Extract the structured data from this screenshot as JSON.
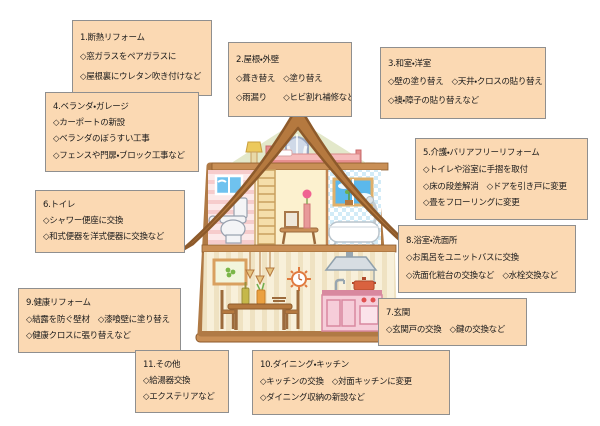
{
  "palette": {
    "callout_fill": "#fbd9b3",
    "callout_border": "#8f8f8f",
    "roof_brown": "#b5793f",
    "wood_frame": "#c98f56",
    "wall_cream": "#fdf5e0",
    "attic_green": "#e3e8ca",
    "toilet_room_pink": "#fce9e9",
    "bathroom_blue": "#d2ebf7",
    "kitchen_pink": "#f6cdd9"
  },
  "boxes": [
    {
      "title": "1.断熱リフォーム",
      "lines": [
        "◇窓ガラスをペアガラスに",
        "◇屋根裏にウレタン吹き付けなど"
      ]
    },
    {
      "title": "2.屋根・外壁",
      "lines": [
        "◇葺き替え　◇塗り替え",
        "◇雨漏り　　◇ヒビ割れ補修など"
      ]
    },
    {
      "title": "3.和室・洋室",
      "lines": [
        "◇壁の塗り替え　◇天井・クロスの貼り替え",
        "◇襖・障子の貼り替えなど"
      ]
    },
    {
      "title": "4.ベランダ・ガレージ",
      "lines": [
        "◇カーポートの新設",
        "◇ベランダのぼうすい工事",
        "◇フェンスや門扉・ブロック工事など"
      ]
    },
    {
      "title": "5.介護・バリアフリーリフォーム",
      "lines": [
        "◇トイレや浴室に手摺を取付",
        "◇床の段差解消　◇ドアを引き戸に変更",
        "◇畳をフローリングに変更"
      ]
    },
    {
      "title": "6.トイレ",
      "lines": [
        "◇シャワー便座に交換",
        "◇和式便器を洋式便器に交換など"
      ]
    },
    {
      "title": "8.浴室・洗面所",
      "lines": [
        "◇お風呂をユニットバスに交換",
        "◇洗面化粧台の交換など　◇水栓交換など"
      ]
    },
    {
      "title": "7.玄関",
      "lines": [
        "◇玄関戸の交換　◇鍵の交換など"
      ]
    },
    {
      "title": "9.健康リフォーム",
      "lines": [
        "◇結露を防ぐ壁材　◇漆喰壁に塗り替え",
        "◇健康クロスに張り替えなど"
      ]
    },
    {
      "title": "11.その他",
      "lines": [
        "◇給湯器交換",
        "◇エクステリアなど"
      ]
    },
    {
      "title": "10.ダイニング・キッチン",
      "lines": [
        "◇キッチンの交換　◇対面キッチンに変更",
        "◇ダイニング収納の新設など"
      ]
    }
  ]
}
